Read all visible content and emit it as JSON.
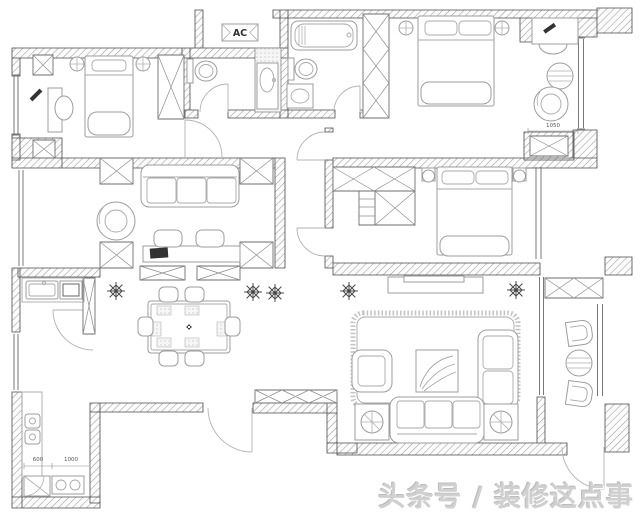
{
  "plan": {
    "ac_label": "AC",
    "dimensions": {
      "master_recess": "1050",
      "kitchen_left": "600",
      "kitchen_right": "1000"
    },
    "watermark": "头条号 / 装修这点事"
  }
}
